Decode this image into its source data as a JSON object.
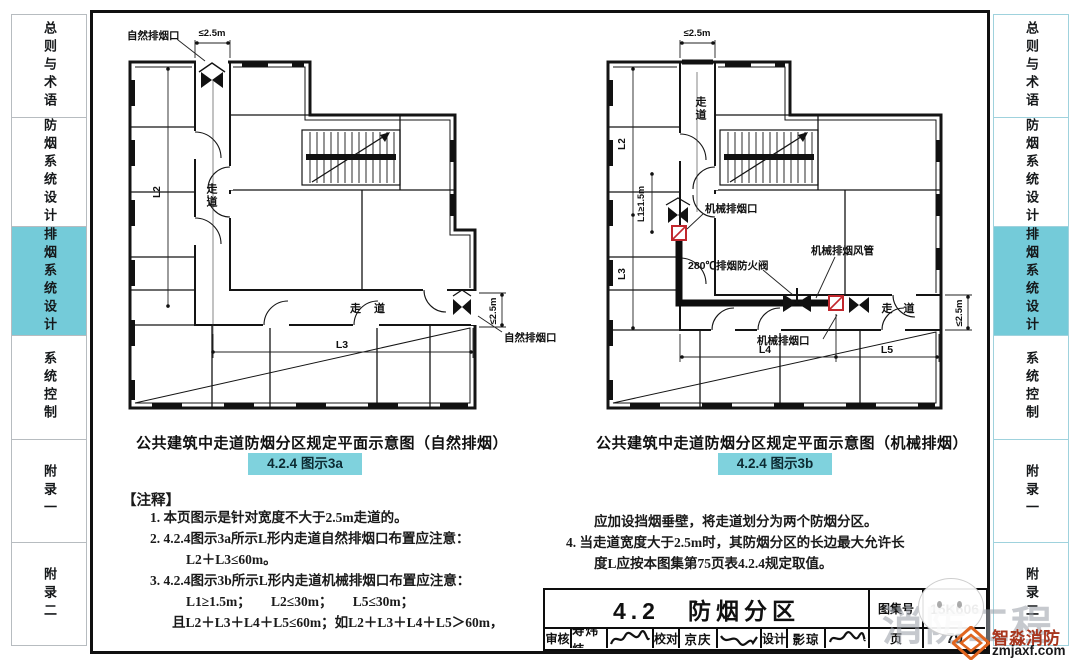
{
  "sidebar": {
    "tabs": [
      {
        "label": "总则与术语",
        "active": false
      },
      {
        "label": "防烟系统设计",
        "active": false
      },
      {
        "label": "排烟系统设计",
        "active": true
      },
      {
        "label": "系统控制",
        "active": false
      },
      {
        "label": "附录一",
        "active": false
      },
      {
        "label": "附录二",
        "active": false
      }
    ]
  },
  "diagram_a": {
    "caption": "公共建筑中走道防烟分区规定平面示意图（自然排烟）",
    "badge": "4.2.4 图示3a",
    "labels": {
      "top_vent": "自然排烟口",
      "right_vent": "自然排烟口",
      "top_dim": "≤2.5m",
      "right_dim": "≤2.5m",
      "corridor_v": "走道",
      "corridor_h": "走 道",
      "l2": "L2",
      "l3": "L3"
    }
  },
  "diagram_b": {
    "caption": "公共建筑中走道防烟分区规定平面示意图（机械排烟）",
    "badge": "4.2.4 图示3b",
    "labels": {
      "vent_top": "机械排烟口",
      "vent_mid": "机械排烟口",
      "valve": "280℃排烟防火阀",
      "duct": "机械排烟风管",
      "top_dim": "≤2.5m",
      "right_dim": "≤2.5m",
      "corridor_v": "走道",
      "corridor_h": "走 道",
      "l1": "L1≥1.5m",
      "l2": "L2",
      "l3": "L3",
      "l4": "L4",
      "l5": "L5"
    }
  },
  "notes": {
    "header": "【注释】",
    "left_lines": [
      "1.  本页图示是针对宽度不大于2.5m走道的。",
      "2.  4.2.4图示3a所示L形内走道自然排烟口布置应注意：",
      "L2＋L3≤60m。",
      "3.  4.2.4图示3b所示L形内走道机械排烟口布置应注意：",
      "L1≥1.5m；　　L2≤30m；　　L5≤30m；",
      "且L2＋L3＋L4＋L5≤60m；如L2＋L3＋L4＋L5＞60m，"
    ],
    "right_lines": [
      "应加设挡烟垂壁，将走道划分为两个防烟分区。",
      "4.  当走道宽度大于2.5m时，其防烟分区的长边最大允许长",
      "度L应按本图集第75页表4.2.4规定取值。"
    ]
  },
  "title_block": {
    "section_title": "4.2　防烟分区",
    "atlas_label": "图集号",
    "atlas_no": "15K606",
    "page_label": "页",
    "page_no": "79",
    "reviewer_label": "审核",
    "reviewer": "寿炜炜",
    "checker_label": "校对",
    "checker": "京庆",
    "designer_label": "设计",
    "designer": "影琼"
  },
  "watermark": {
    "big": "消防工程",
    "brand": "智淼消防",
    "site": "zmjaxf.com"
  },
  "colors": {
    "tab_active": "#74cbd9",
    "badge_bg": "#7fd2dd",
    "vent_red": "#c1272d"
  }
}
